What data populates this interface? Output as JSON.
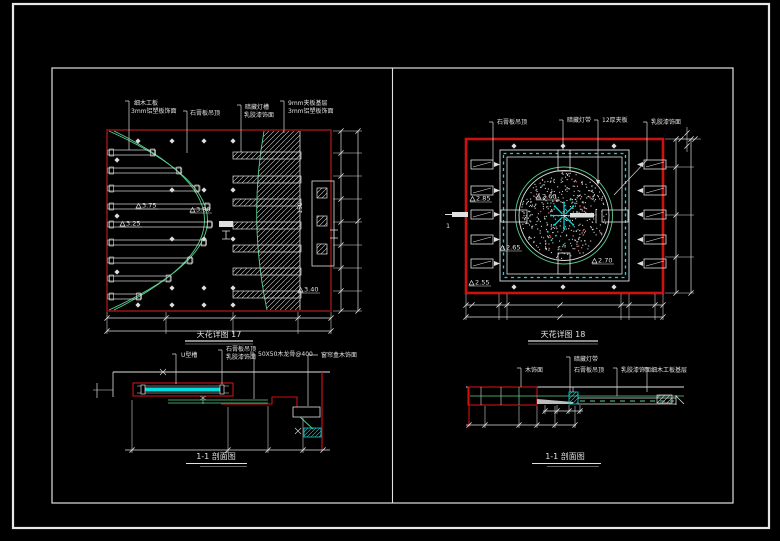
{
  "colors": {
    "background": "#000000",
    "line_white": "#e0e0e0",
    "red_bright": "#cc1111",
    "red_dark": "#8a1515",
    "green": "#5bcf8f",
    "cyan": "#00dddd"
  },
  "left_plan": {
    "title": "天花详图 17",
    "labels": {
      "l1a": "细木工板",
      "l1b": "3mm铝塑板饰面",
      "l2": "石膏板吊顶",
      "l3a": "暗藏灯槽",
      "l3b": "乳胶漆饰面",
      "l4a": "9mm夹板基层",
      "l4b": "3mm铝塑板饰面"
    },
    "elevations": {
      "e1": "3.75",
      "e2": "3.25",
      "e3": "3.80",
      "e4": "3.40"
    },
    "dim_note": "150"
  },
  "right_plan": {
    "title": "天花详图 18",
    "labels": {
      "l1": "石膏板吊顶",
      "l2": "暗藏灯带",
      "l3": "12厚夹板",
      "l4": "乳胶漆饰面"
    },
    "elevations": {
      "e1": "2.85",
      "e2": "2.65",
      "e3": "2.70",
      "e4": "2.55",
      "center": "2.60"
    },
    "section_label": "1"
  },
  "left_section": {
    "title": "1-1 剖面图",
    "labels": {
      "l1": "U型槽",
      "l2a": "石膏板吊顶",
      "l2b": "乳胶漆饰面",
      "l3": "50X50木龙骨@400",
      "l4": "窗帘盒木饰面"
    }
  },
  "right_section": {
    "title": "1-1 剖面图",
    "labels": {
      "l1": "木饰面",
      "l2a": "暗藏灯带",
      "l2b": "石膏板吊顶",
      "l3": "乳胶漆饰面",
      "l4": "细木工板基层"
    }
  }
}
